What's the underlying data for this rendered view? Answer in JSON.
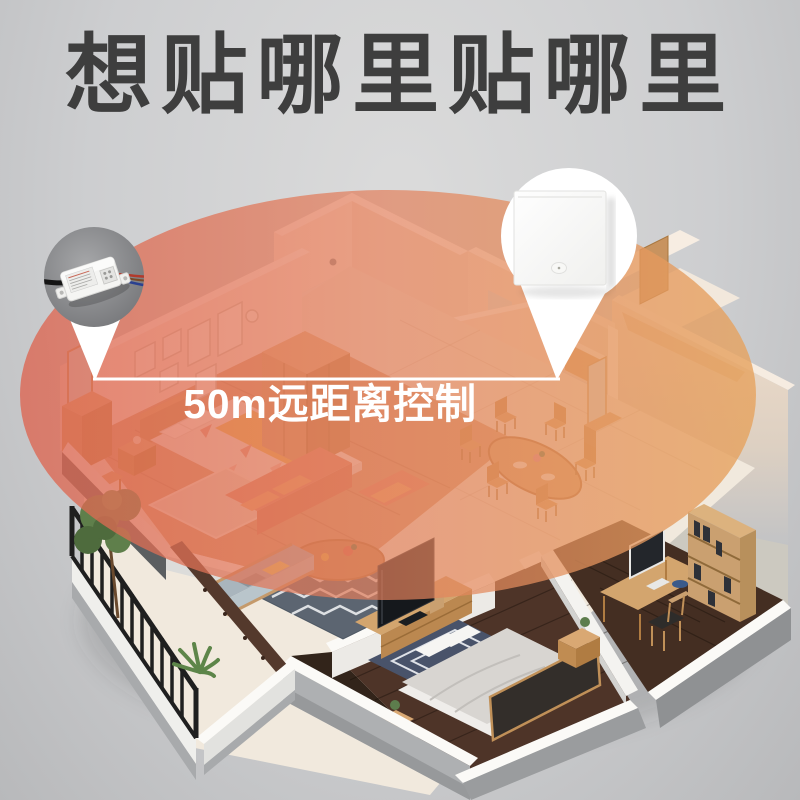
{
  "title": "想贴哪里贴哪里",
  "range_callout": {
    "label": "50m远距离控制"
  },
  "callouts": {
    "receiver": {
      "icon": "rf-receiver-module-icon"
    },
    "switch": {
      "icon": "wireless-wall-switch-icon"
    }
  },
  "colors": {
    "title_text": "#3e3e3e",
    "range_text": "#ffffff",
    "range_left": "#dd6450",
    "range_mid": "#e2805c",
    "range_right": "#e6a35e",
    "callout_circle_gray": "#8d8e90",
    "callout_circle_white": "#ffffff"
  }
}
